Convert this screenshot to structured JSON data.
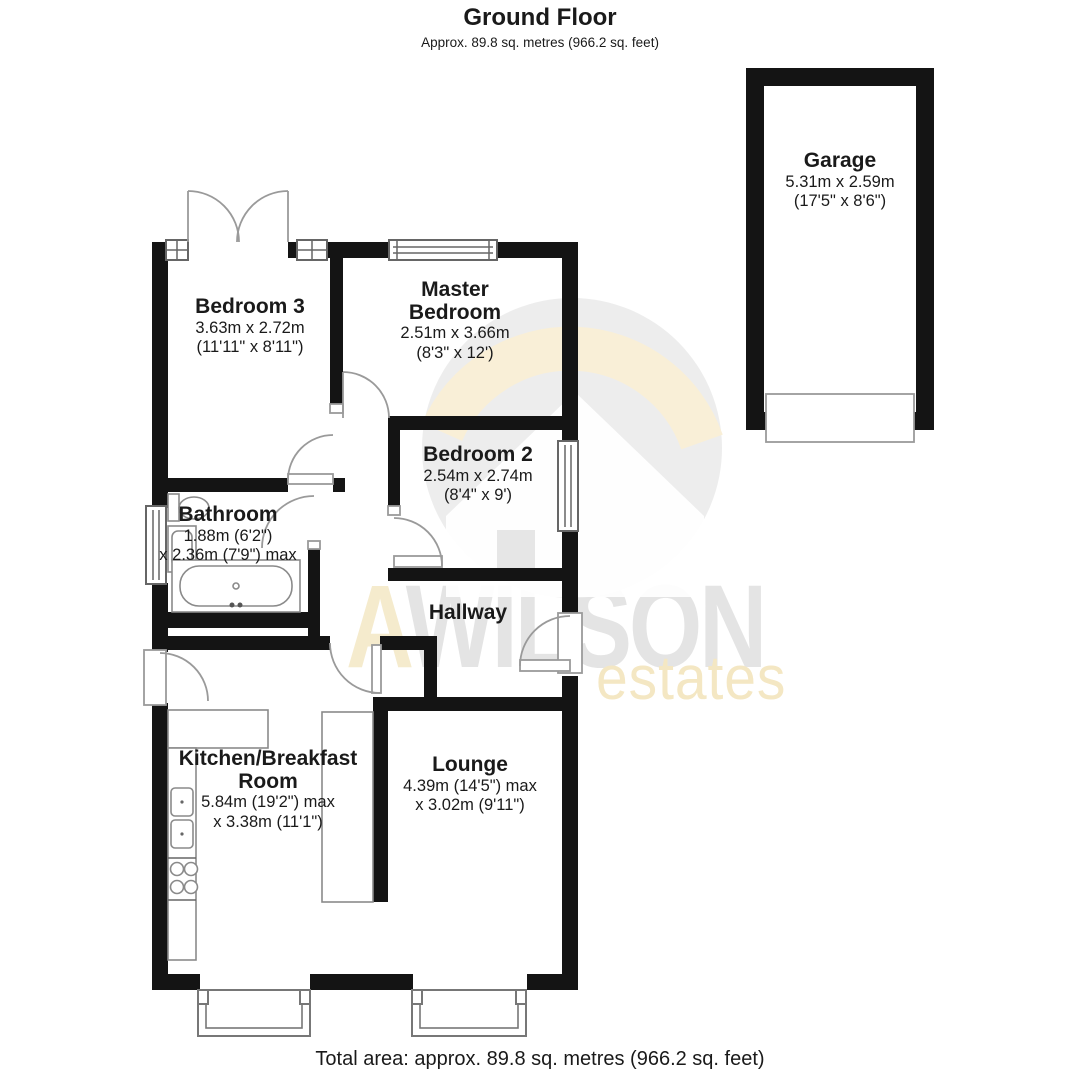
{
  "page": {
    "title": "Ground Floor",
    "subtitle": "Approx. 89.8 sq. metres (966.2 sq. feet)",
    "footer": "Total area: approx. 89.8 sq. metres (966.2 sq. feet)"
  },
  "watermark": {
    "prefix": "A",
    "name": "WILSON",
    "tagline": "estates"
  },
  "colors": {
    "wall": "#141414",
    "watermark_gray": "#e4e4e4",
    "watermark_cream": "#f4e7c3"
  },
  "rooms": {
    "garage": {
      "name": "Garage",
      "metric": "5.31m x 2.59m",
      "imperial": "(17'5\" x 8'6\")"
    },
    "bedroom3": {
      "name": "Bedroom 3",
      "metric": "3.63m x 2.72m",
      "imperial": "(11'11\" x 8'11\")"
    },
    "master": {
      "name_line1": "Master",
      "name_line2": "Bedroom",
      "metric": "2.51m x 3.66m",
      "imperial": "(8'3\" x 12')"
    },
    "bedroom2": {
      "name": "Bedroom 2",
      "metric": "2.54m x 2.74m",
      "imperial": "(8'4\" x 9')"
    },
    "bathroom": {
      "name": "Bathroom",
      "dims_line1": "1.88m (6'2\")",
      "dims_line2": "x 2.36m (7'9\") max"
    },
    "hallway": {
      "name": "Hallway"
    },
    "kitchen": {
      "name_line1": "Kitchen/Breakfast",
      "name_line2": "Room",
      "dims_line1": "5.84m (19'2\") max",
      "dims_line2": "x 3.38m (11'1\")"
    },
    "lounge": {
      "name": "Lounge",
      "dims_line1": "4.39m (14'5\") max",
      "dims_line2": "x 3.02m (9'11\")"
    }
  }
}
